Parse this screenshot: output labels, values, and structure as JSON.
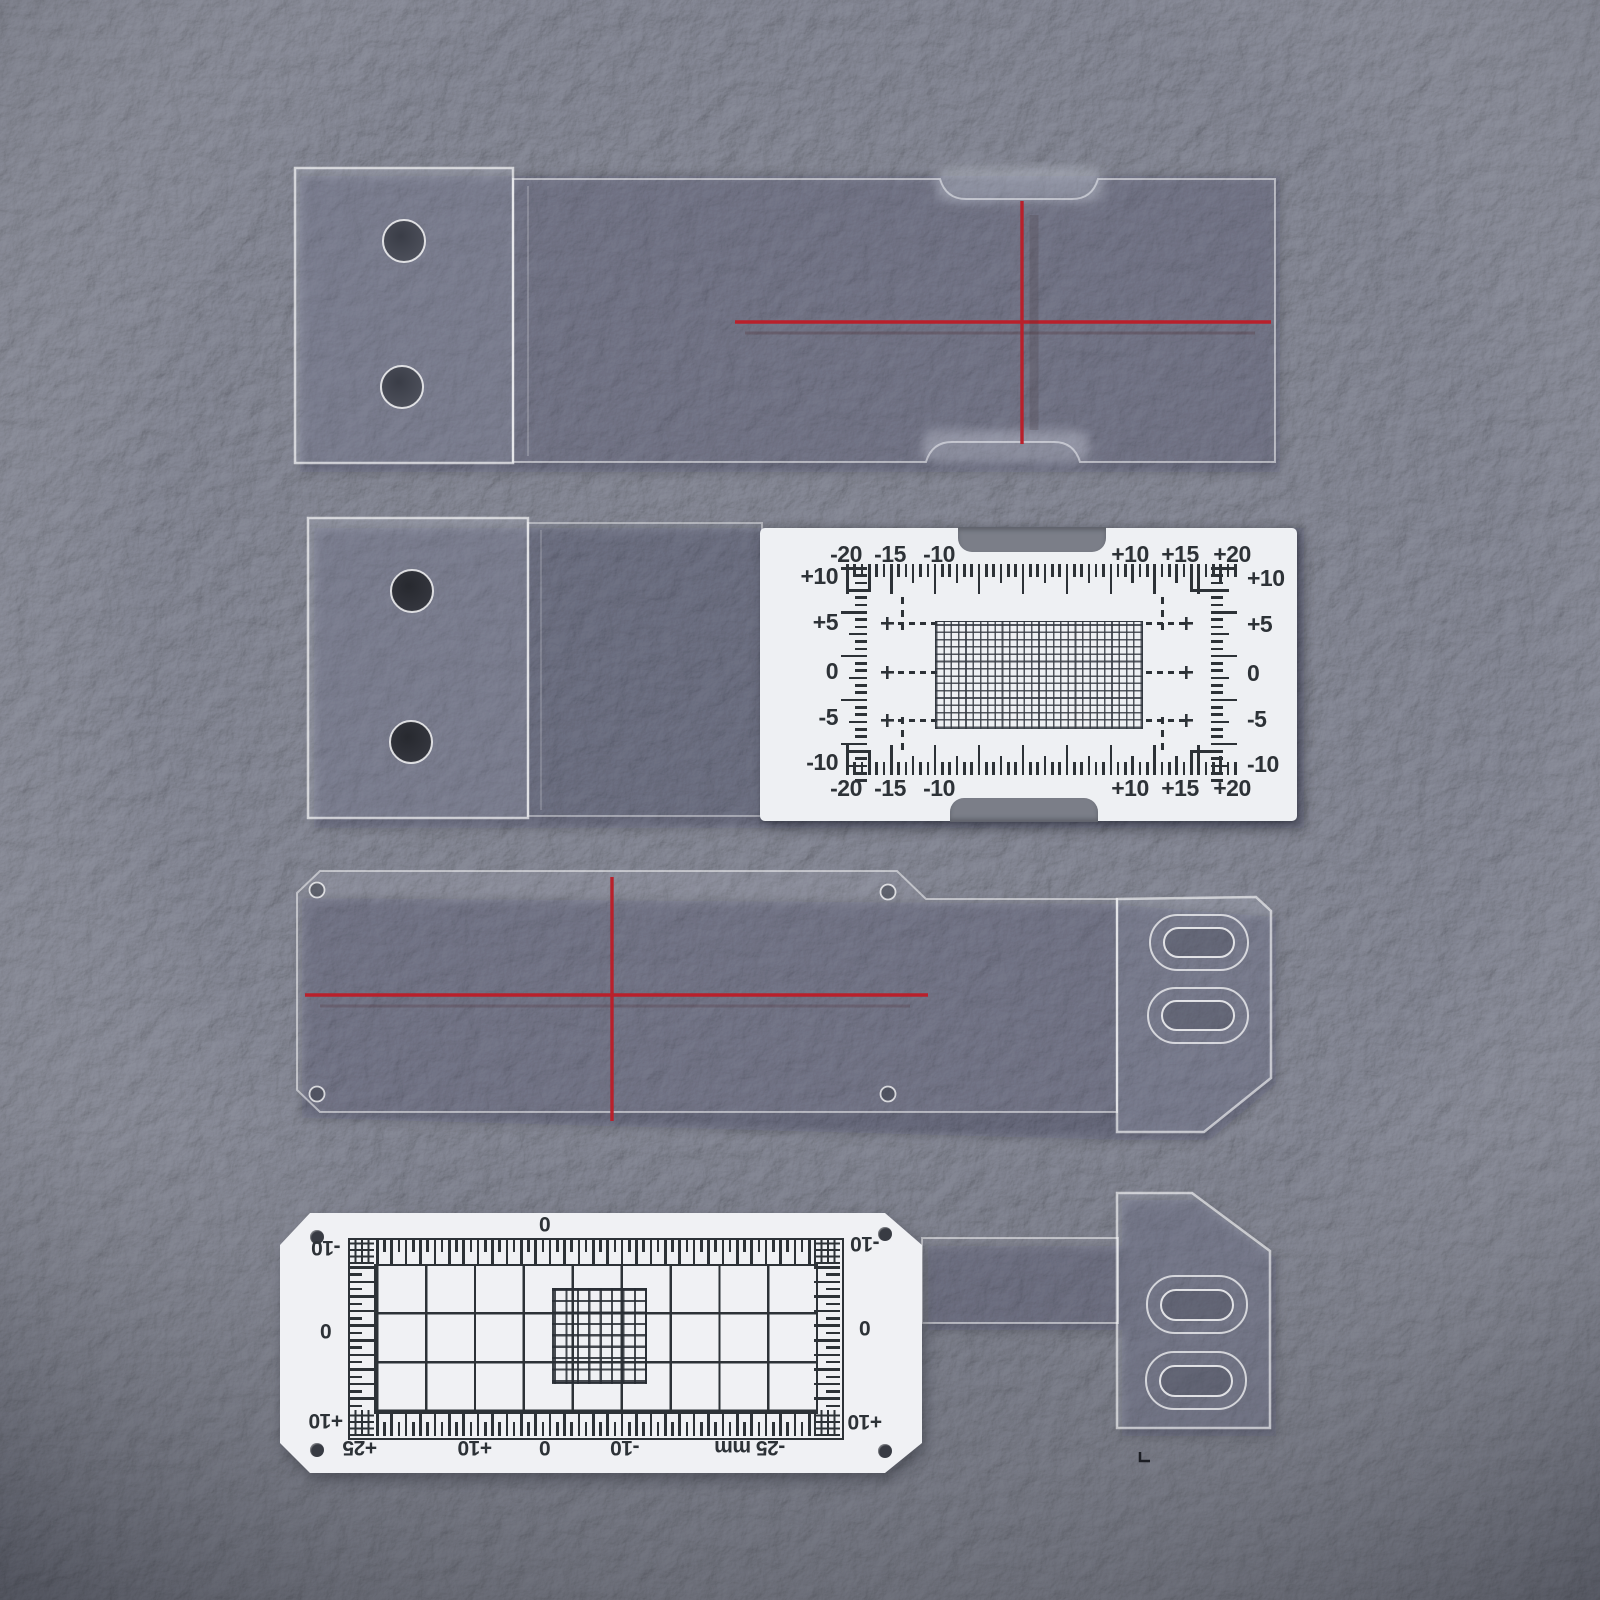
{
  "card_upper": {
    "top_labels": [
      "-20",
      "-15",
      "-10",
      "+10",
      "+15",
      "+20"
    ],
    "bottom_labels": [
      "-20",
      "-15",
      "-10",
      "+10",
      "+15",
      "+20"
    ],
    "left_labels": [
      "+10",
      "+5",
      "0",
      "-5",
      "-10"
    ],
    "right_labels": [
      "+10",
      "+5",
      "0",
      "-5",
      "-10"
    ]
  },
  "card_lower": {
    "top_label": "0",
    "left_labels": [
      "-10",
      "0",
      "+10"
    ],
    "right_labels": [
      "-10",
      "0",
      "+10"
    ],
    "bottom_labels": [
      "+25",
      "+10",
      "0",
      "-10",
      "-25 mm"
    ]
  },
  "colors": {
    "background": "#7d808c",
    "card": "#eef0f3",
    "print": "#2d3237",
    "red_line": "#b9202b"
  }
}
